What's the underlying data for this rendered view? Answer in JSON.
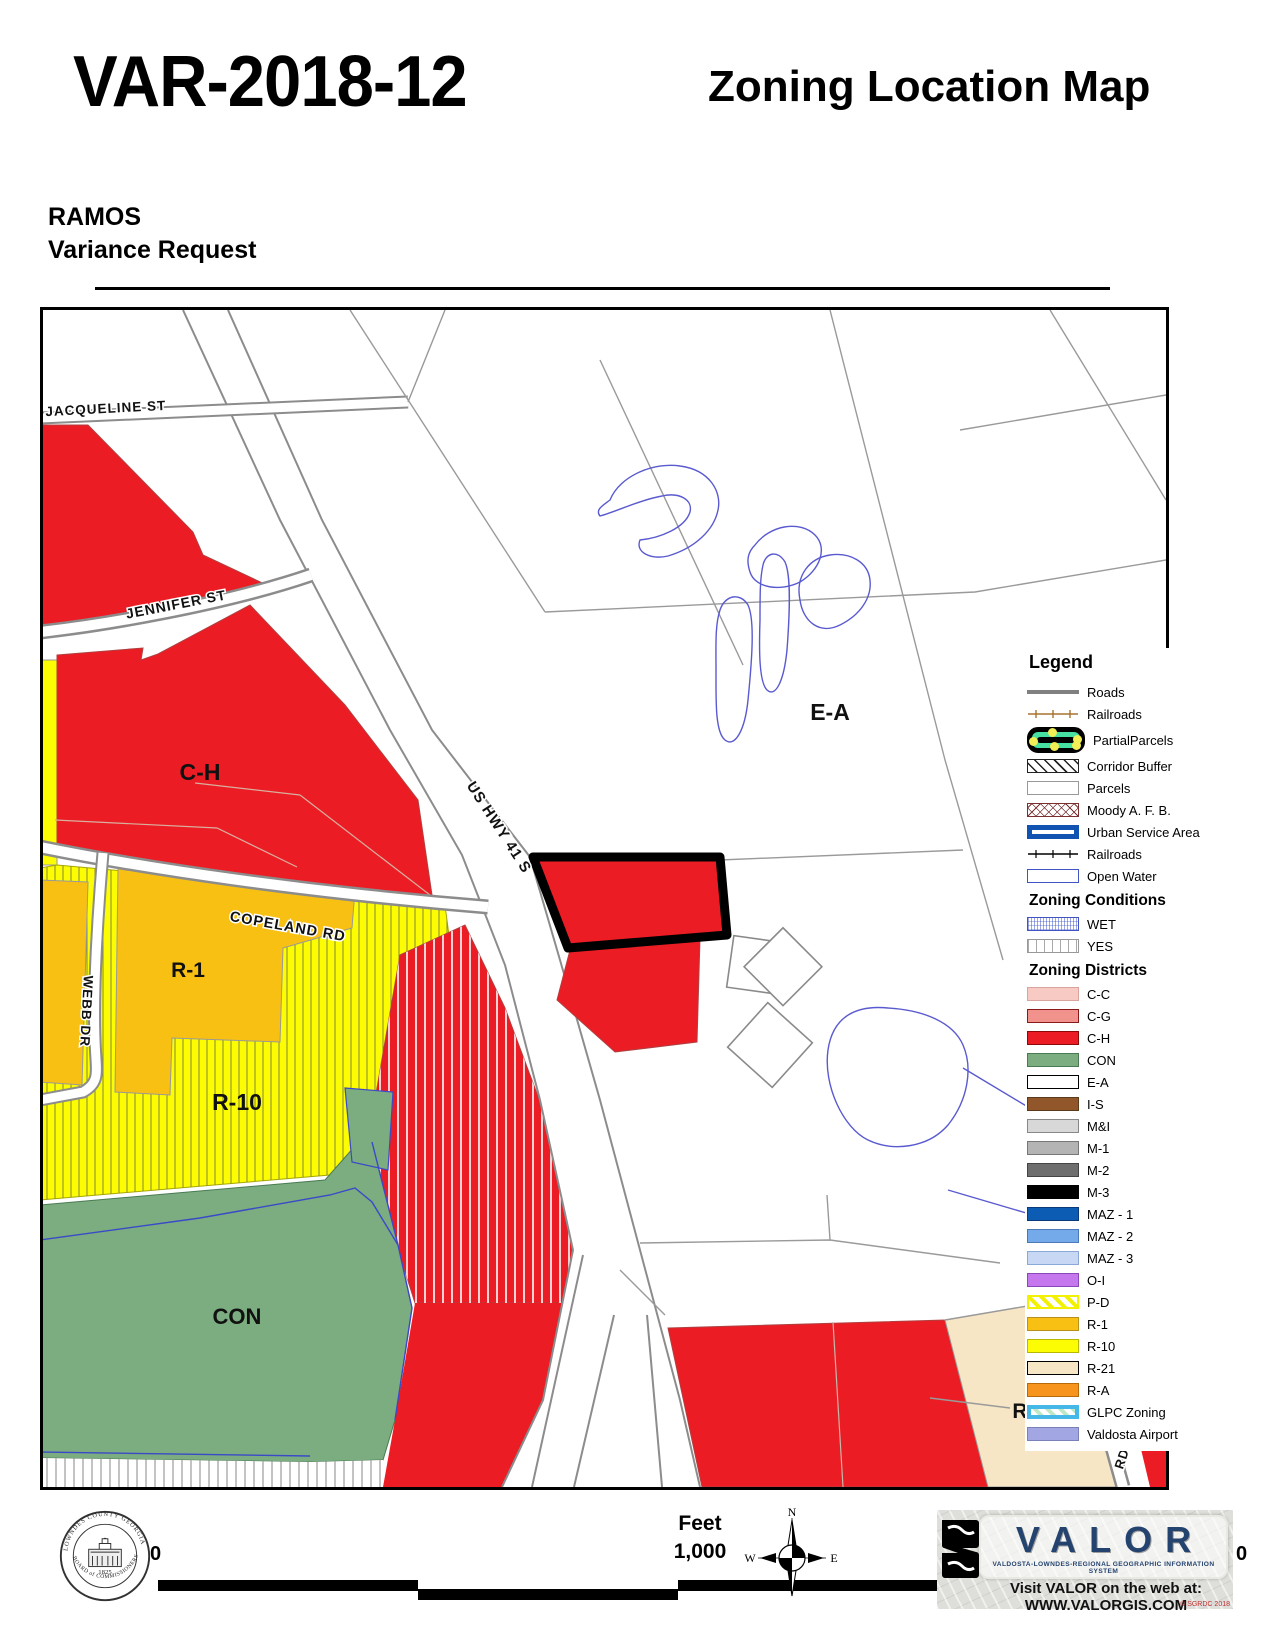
{
  "header": {
    "case_number": "VAR-2018-12",
    "map_type": "Zoning Location Map",
    "applicant": "RAMOS",
    "request": "Variance Request"
  },
  "map": {
    "street_labels": {
      "jacqueline": "JACQUELINE ST",
      "jennifer": "JENNIFER ST",
      "us_hwy": "US HWY 41 S",
      "copeland": "COPELAND RD",
      "webb": "WEBB DR",
      "rd": "RD"
    },
    "zone_labels": {
      "ch": "C-H",
      "r1": "R-1",
      "r10": "R-10",
      "con": "CON",
      "ea": "E-A",
      "r_partial": "R"
    },
    "zone_colors": {
      "red_ch": "#EC1C24",
      "yellow_r10": "#FCFC02",
      "amber_r1": "#F9C014",
      "green_con": "#7BAD80",
      "tan_r21": "#F7E6C6",
      "white_ea": "#FFFFFF",
      "subject_outline": "#000000",
      "wetland_line": "#5A5AD0"
    }
  },
  "legend": {
    "title": "Legend",
    "general": [
      {
        "label": "Roads",
        "symbol": "roads-line"
      },
      {
        "label": "Railroads",
        "symbol": "railroad-brown-line"
      },
      {
        "label": "PartialParcels",
        "symbol": "partial-parcels"
      },
      {
        "label": "Corridor Buffer",
        "symbol": "corridor-buffer-hatch"
      },
      {
        "label": "Parcels",
        "symbol": "parcels-box"
      },
      {
        "label": "Moody A. F. B.",
        "symbol": "moody-crosshatch"
      },
      {
        "label": "Urban Service Area",
        "symbol": "urban-service-area-box"
      },
      {
        "label": "Railroads",
        "symbol": "railroad-black-line"
      },
      {
        "label": "Open Water",
        "symbol": "open-water-box"
      }
    ],
    "conditions_header": "Zoning Conditions",
    "conditions": [
      {
        "label": "WET"
      },
      {
        "label": "YES"
      }
    ],
    "districts_header": "Zoning Districts",
    "districts": [
      {
        "label": "C-C",
        "color": "#F7CAC4"
      },
      {
        "label": "C-G",
        "color": "#F2928C"
      },
      {
        "label": "C-H",
        "color": "#EC1C24"
      },
      {
        "label": "CON",
        "color": "#7BAD80"
      },
      {
        "label": "E-A",
        "color": "#FFFFFF"
      },
      {
        "label": "I-S",
        "color": "#92562B"
      },
      {
        "label": "M&I",
        "color": "#D8D8D8"
      },
      {
        "label": "M-1",
        "color": "#B4B4B4"
      },
      {
        "label": "M-2",
        "color": "#6E6E6E"
      },
      {
        "label": "M-3",
        "color": "#000000"
      },
      {
        "label": "MAZ - 1",
        "color": "#0C5CB4"
      },
      {
        "label": "MAZ - 2",
        "color": "#74A9EA"
      },
      {
        "label": "MAZ - 3",
        "color": "#C8D8F4"
      },
      {
        "label": "O-I",
        "color": "#C578EE"
      },
      {
        "label": "P-D",
        "color": "#F2F104"
      },
      {
        "label": "R-1",
        "color": "#F9C014"
      },
      {
        "label": "R-10",
        "color": "#FCFC02"
      },
      {
        "label": "R-21",
        "color": "#F7E6C6"
      },
      {
        "label": "R-A",
        "color": "#F7941E"
      },
      {
        "label": "GLPC Zoning",
        "color": "#BDE7C5"
      },
      {
        "label": "Valdosta Airport",
        "color": "#A2A6E2"
      }
    ]
  },
  "footer": {
    "scale_unit": "Feet",
    "scale_value": "1,000",
    "scale_left": "0",
    "scale_right": "0",
    "compass": {
      "n": "N",
      "w": "W",
      "e": "E"
    },
    "seal": {
      "top": "LOWNDES COUNTY GEORGIA",
      "bottom": "BOARD of COMMISSIONERS",
      "year": "1825"
    },
    "valor": {
      "name": "VALOR",
      "tagline": "VALDOSTA-LOWNDES-REGIONAL GEOGRAPHIC INFORMATION SYSTEM",
      "web": "Visit VALOR on the web at: WWW.VALORGIS.COM",
      "copyright": "© SGRDC 2018"
    }
  }
}
